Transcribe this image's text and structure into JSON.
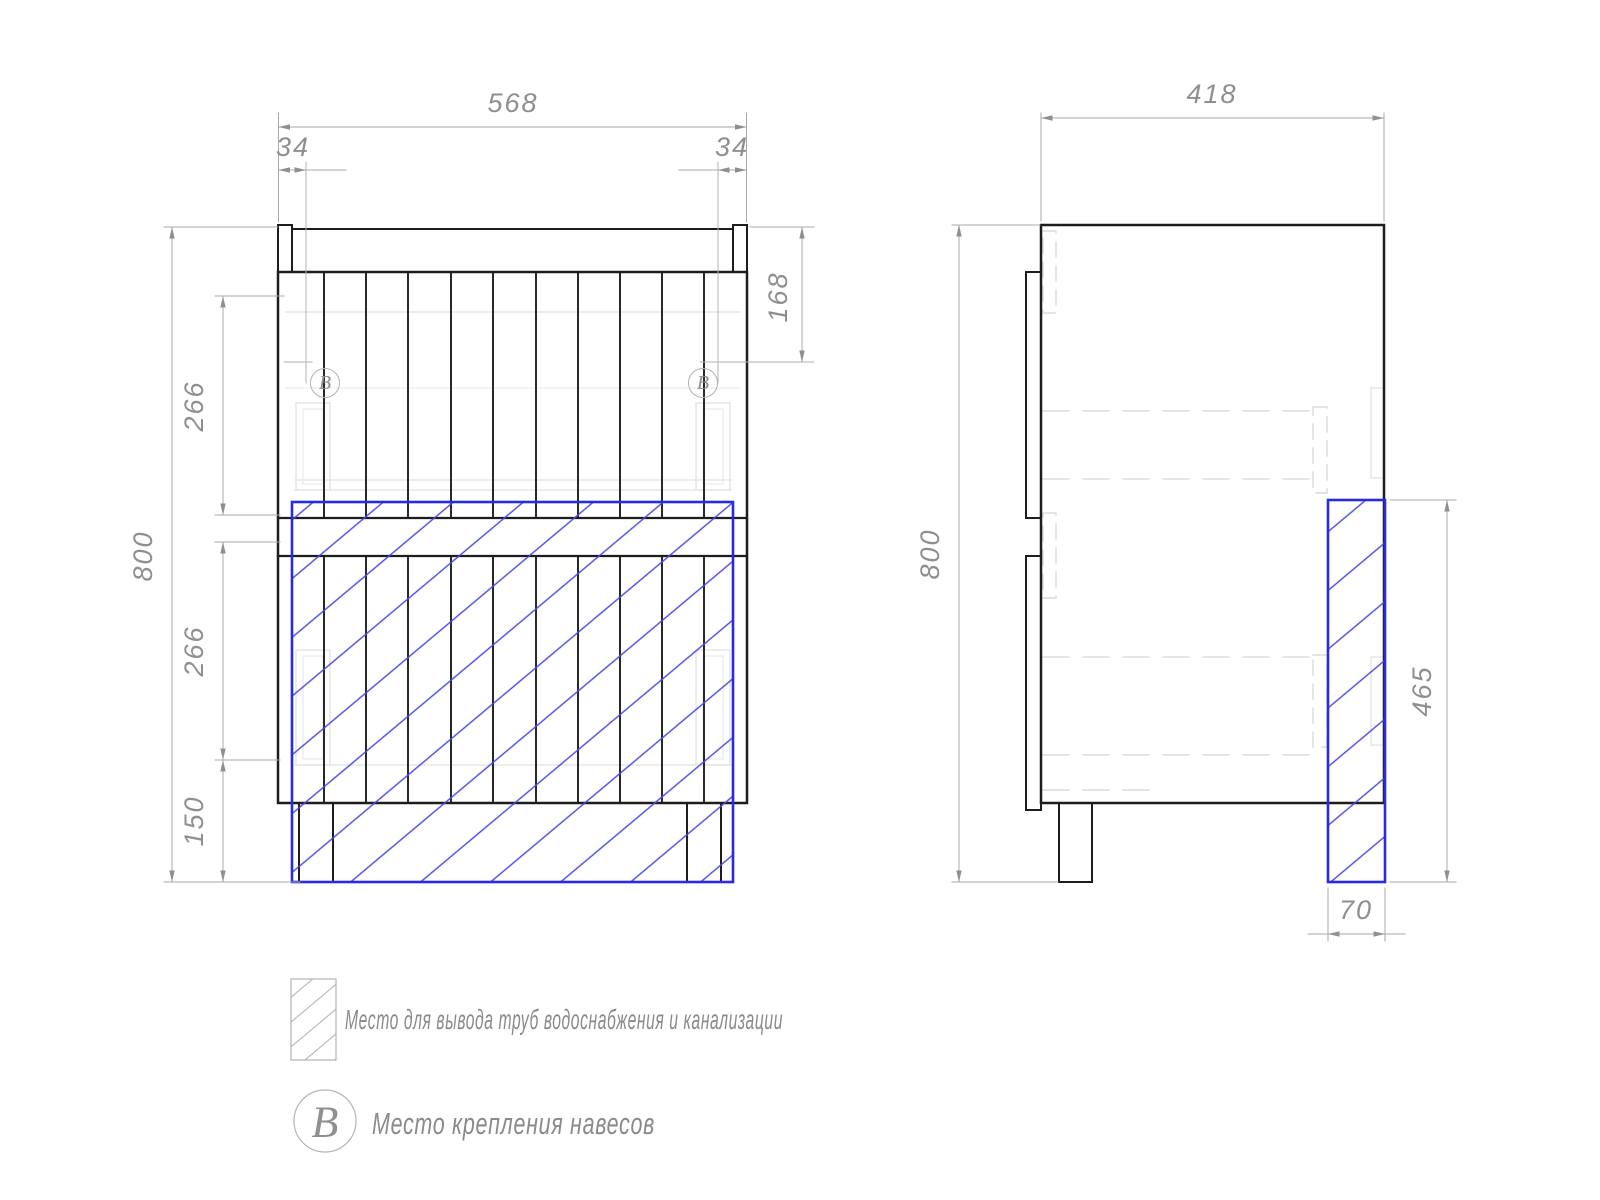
{
  "drawing": {
    "front": {
      "dim_width": "568",
      "dim_offset_left": "34",
      "dim_offset_right": "34",
      "dim_mount": "168",
      "dim_height": "800",
      "dim_upper_drawer": "266",
      "dim_lower_drawer": "266",
      "dim_plinth": "150",
      "mount_mark": "В"
    },
    "side": {
      "dim_depth": "418",
      "dim_height": "800",
      "dim_pipe_height": "465",
      "dim_pipe_width": "70"
    },
    "legend": {
      "pipe_note": "Место для вывода труб водоснабжения и канализации",
      "mount_mark": "В",
      "mount_note": "Место крепления навесов"
    },
    "colors": {
      "outline": "#1d1d1d",
      "dimension": "#969696",
      "hidden_detail": "#dcdcdc",
      "pipe_zone_blue": "#2a2ae0"
    }
  }
}
